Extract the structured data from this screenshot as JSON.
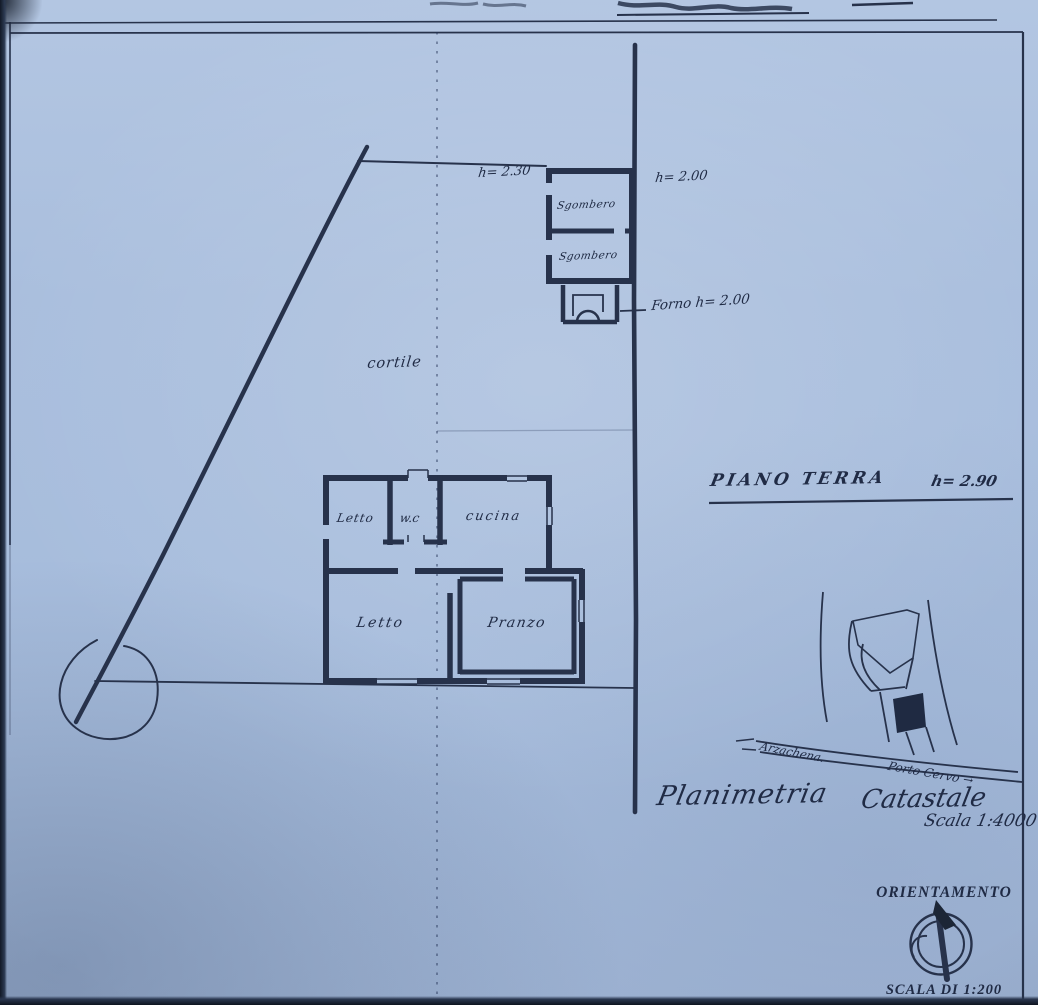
{
  "document": {
    "paper_color": "#a9bedd",
    "ink_color": "#27324b"
  },
  "plan": {
    "cortile": "cortile",
    "piano_terra": "PIANO TERRA",
    "piano_terra_height": "h= 2.90",
    "heights": {
      "left": "h= 2.30",
      "right": "h= 2.00",
      "forno": "Forno h= 2.00"
    },
    "rooms": {
      "sgombero_1": "Sgombero",
      "sgombero_2": "Sgombero",
      "letto_small": "Letto",
      "wc": "w.c",
      "cucina": "cucina",
      "letto_large": "Letto",
      "pranzo": "Pranzo"
    }
  },
  "location_map": {
    "road_left": "Arzachena.",
    "road_right": "Porto Cervo →",
    "caption_left": "Planimetria",
    "caption_right": "Catastale",
    "scale": "Scala 1:4000"
  },
  "orientation": {
    "title": "ORIENTAMENTO",
    "scale": "SCALA DI 1:200"
  }
}
